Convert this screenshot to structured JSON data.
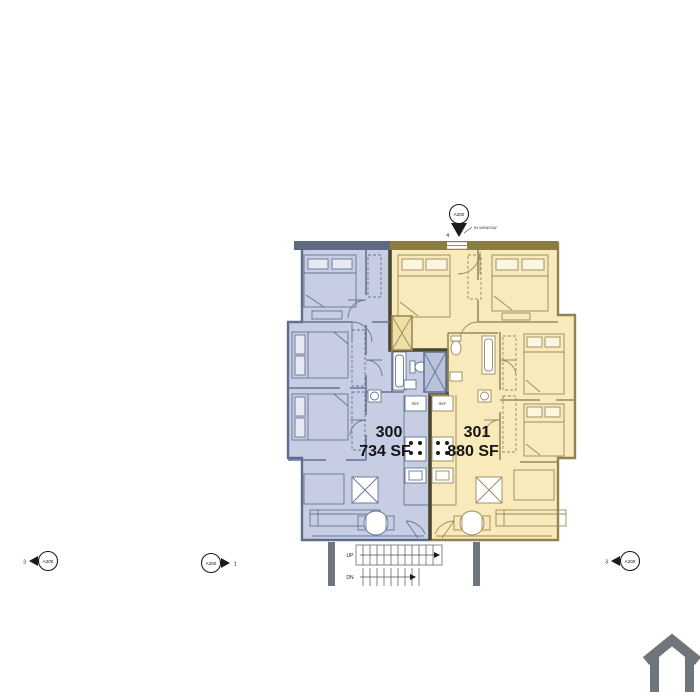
{
  "plan": {
    "units": [
      {
        "number": "300",
        "area": "734 SF",
        "fill": "#c7cee3",
        "wall_color": "#5e6c8e"
      },
      {
        "number": "301",
        "area": "880 SF",
        "fill": "#f9eabc",
        "wall_color": "#93824d"
      }
    ],
    "fridge_label": "REF",
    "demising_wall_color": "#4a452f",
    "top_band_colors": {
      "left": "#5e6a82",
      "right": "#8d7c42"
    }
  },
  "markers": {
    "top": {
      "label": "A200",
      "number": "4",
      "note": "IN WINDOW"
    },
    "left": {
      "label": "A200",
      "number": "3"
    },
    "center": {
      "label": "A200",
      "number": "1"
    },
    "right": {
      "label": "A200",
      "number": "3"
    }
  },
  "stairs": {
    "up": "UP",
    "down": "DN"
  },
  "logo_color": "#6e757c"
}
